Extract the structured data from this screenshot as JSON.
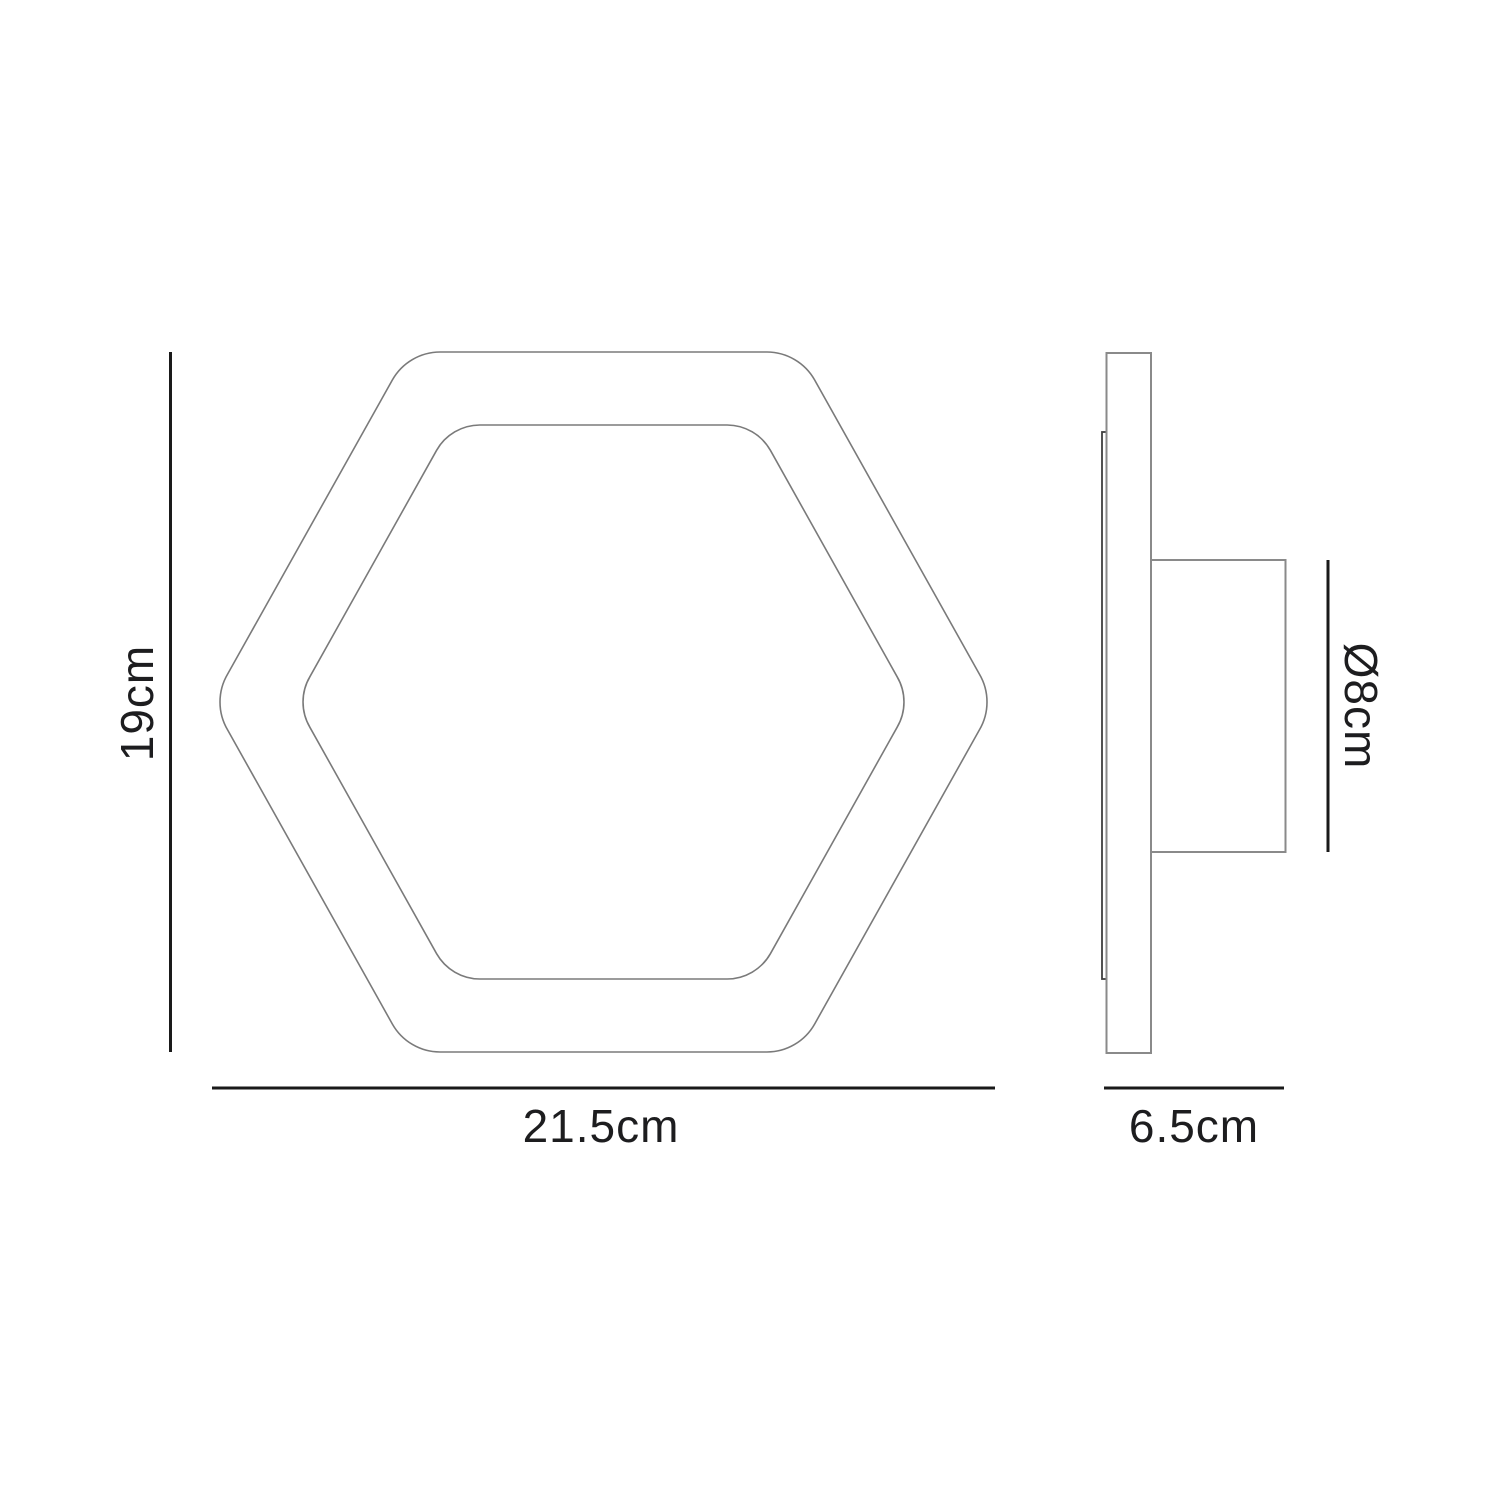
{
  "diagram": {
    "kind": "technical-dimension-drawing",
    "subject": "hexagonal wall light - front and side views",
    "dimensions": {
      "height_label": "19cm",
      "width_label": "21.5cm",
      "depth_label": "6.5cm",
      "diameter_label": "Ø8cm"
    },
    "colors": {
      "background": "#ffffff",
      "drawing_outline": "#7a7a7a",
      "dimension_line": "#1a1a1a",
      "label_text": "#1d1d1f"
    }
  }
}
